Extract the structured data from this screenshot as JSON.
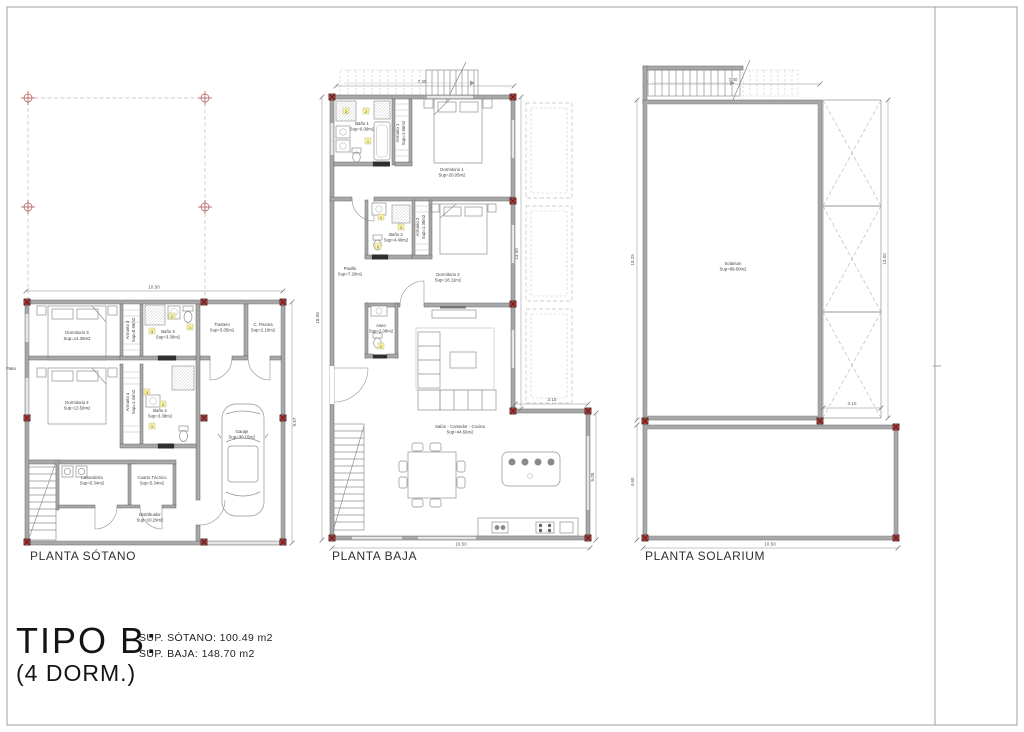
{
  "title_block": {
    "type_label": "TIPO B:",
    "dorm_label": "(4 DORM.)",
    "sup_sotano": "SUP. SÓTANO: 100.49 m2",
    "sup_baja": "SUP. BAJA: 148.70 m2"
  },
  "tags": {
    "1": "1",
    "2": "2",
    "3": "3"
  },
  "plans": {
    "sotano": {
      "title": "PLANTA SÓTANO",
      "dims": {
        "top": "10.50",
        "right": "9.57"
      },
      "rooms": {
        "dormitorio3": {
          "name": "Dormitorio 3",
          "sup": "Sup=14.39m2"
        },
        "armario3": {
          "name": "Armario 3",
          "sup": "Sup=0.96m2"
        },
        "bano3": {
          "name": "Baño 3",
          "sup": "Sup=3.36m2"
        },
        "trastero": {
          "name": "Trastero",
          "sup": "Sup=3.05m2"
        },
        "c_piscina": {
          "name": "C. Piscina",
          "sup": "Sup=2.19m2"
        },
        "dormitorio4": {
          "name": "Dormitorio 4",
          "sup": "Sup=13.58m2"
        },
        "armario4": {
          "name": "Armario 4",
          "sup": "Sup=1.34m2"
        },
        "bano4": {
          "name": "Baño 4",
          "sup": "Sup=3.38m2"
        },
        "lavanderia": {
          "name": "Lavandería",
          "sup": "Sup=5.34m2"
        },
        "cuarto_tecnico": {
          "name": "Cuarto Técnico",
          "sup": "Sup=5.34m2"
        },
        "distribuidor": {
          "name": "Distribuidor",
          "sup": "Sup=10.29m2"
        },
        "garaje": {
          "name": "Garaje",
          "sup": "Sup=30.15m2"
        },
        "patio": {
          "name": "Patio"
        }
      }
    },
    "baja": {
      "title": "PLANTA BAJA",
      "dims": {
        "stair": "7.40",
        "left": "18.06",
        "right": "13.00",
        "step": "3.10",
        "lower_right": "5.05",
        "bottom": "10.50"
      },
      "rooms": {
        "bano1": {
          "name": "Baño 1",
          "sup": "Sup=6.09m2"
        },
        "armario1": {
          "name": "Armario 1",
          "sup": "Sup=1.56m2"
        },
        "dormitorio1": {
          "name": "Dormitorio 1",
          "sup": "Sup=20.05m2"
        },
        "bano2": {
          "name": "Baño 2",
          "sup": "Sup=4.40m2"
        },
        "armario2": {
          "name": "Armario 2",
          "sup": "Sup=1.36m2"
        },
        "dormitorio2": {
          "name": "Dormitorio 2",
          "sup": "Sup=18.11m2"
        },
        "pasillo": {
          "name": "Pasillo",
          "sup": "Sup=7.20m2"
        },
        "aseo": {
          "name": "Aseo",
          "sup": "Sup=2.08m2"
        },
        "salon": {
          "name": "Salón - Comedor - Cocina",
          "sup": "Sup=44.66m2"
        }
      }
    },
    "solarium": {
      "title": "PLANTA SOLARIUM",
      "dims": {
        "stair": "7.40",
        "left": "13.25",
        "right": "13.00",
        "step": "3.10",
        "lower_left": "4.60",
        "bottom": "10.50"
      },
      "rooms": {
        "solarium": {
          "name": "Solarium",
          "sup": "Sup=89.60m2"
        }
      }
    }
  }
}
